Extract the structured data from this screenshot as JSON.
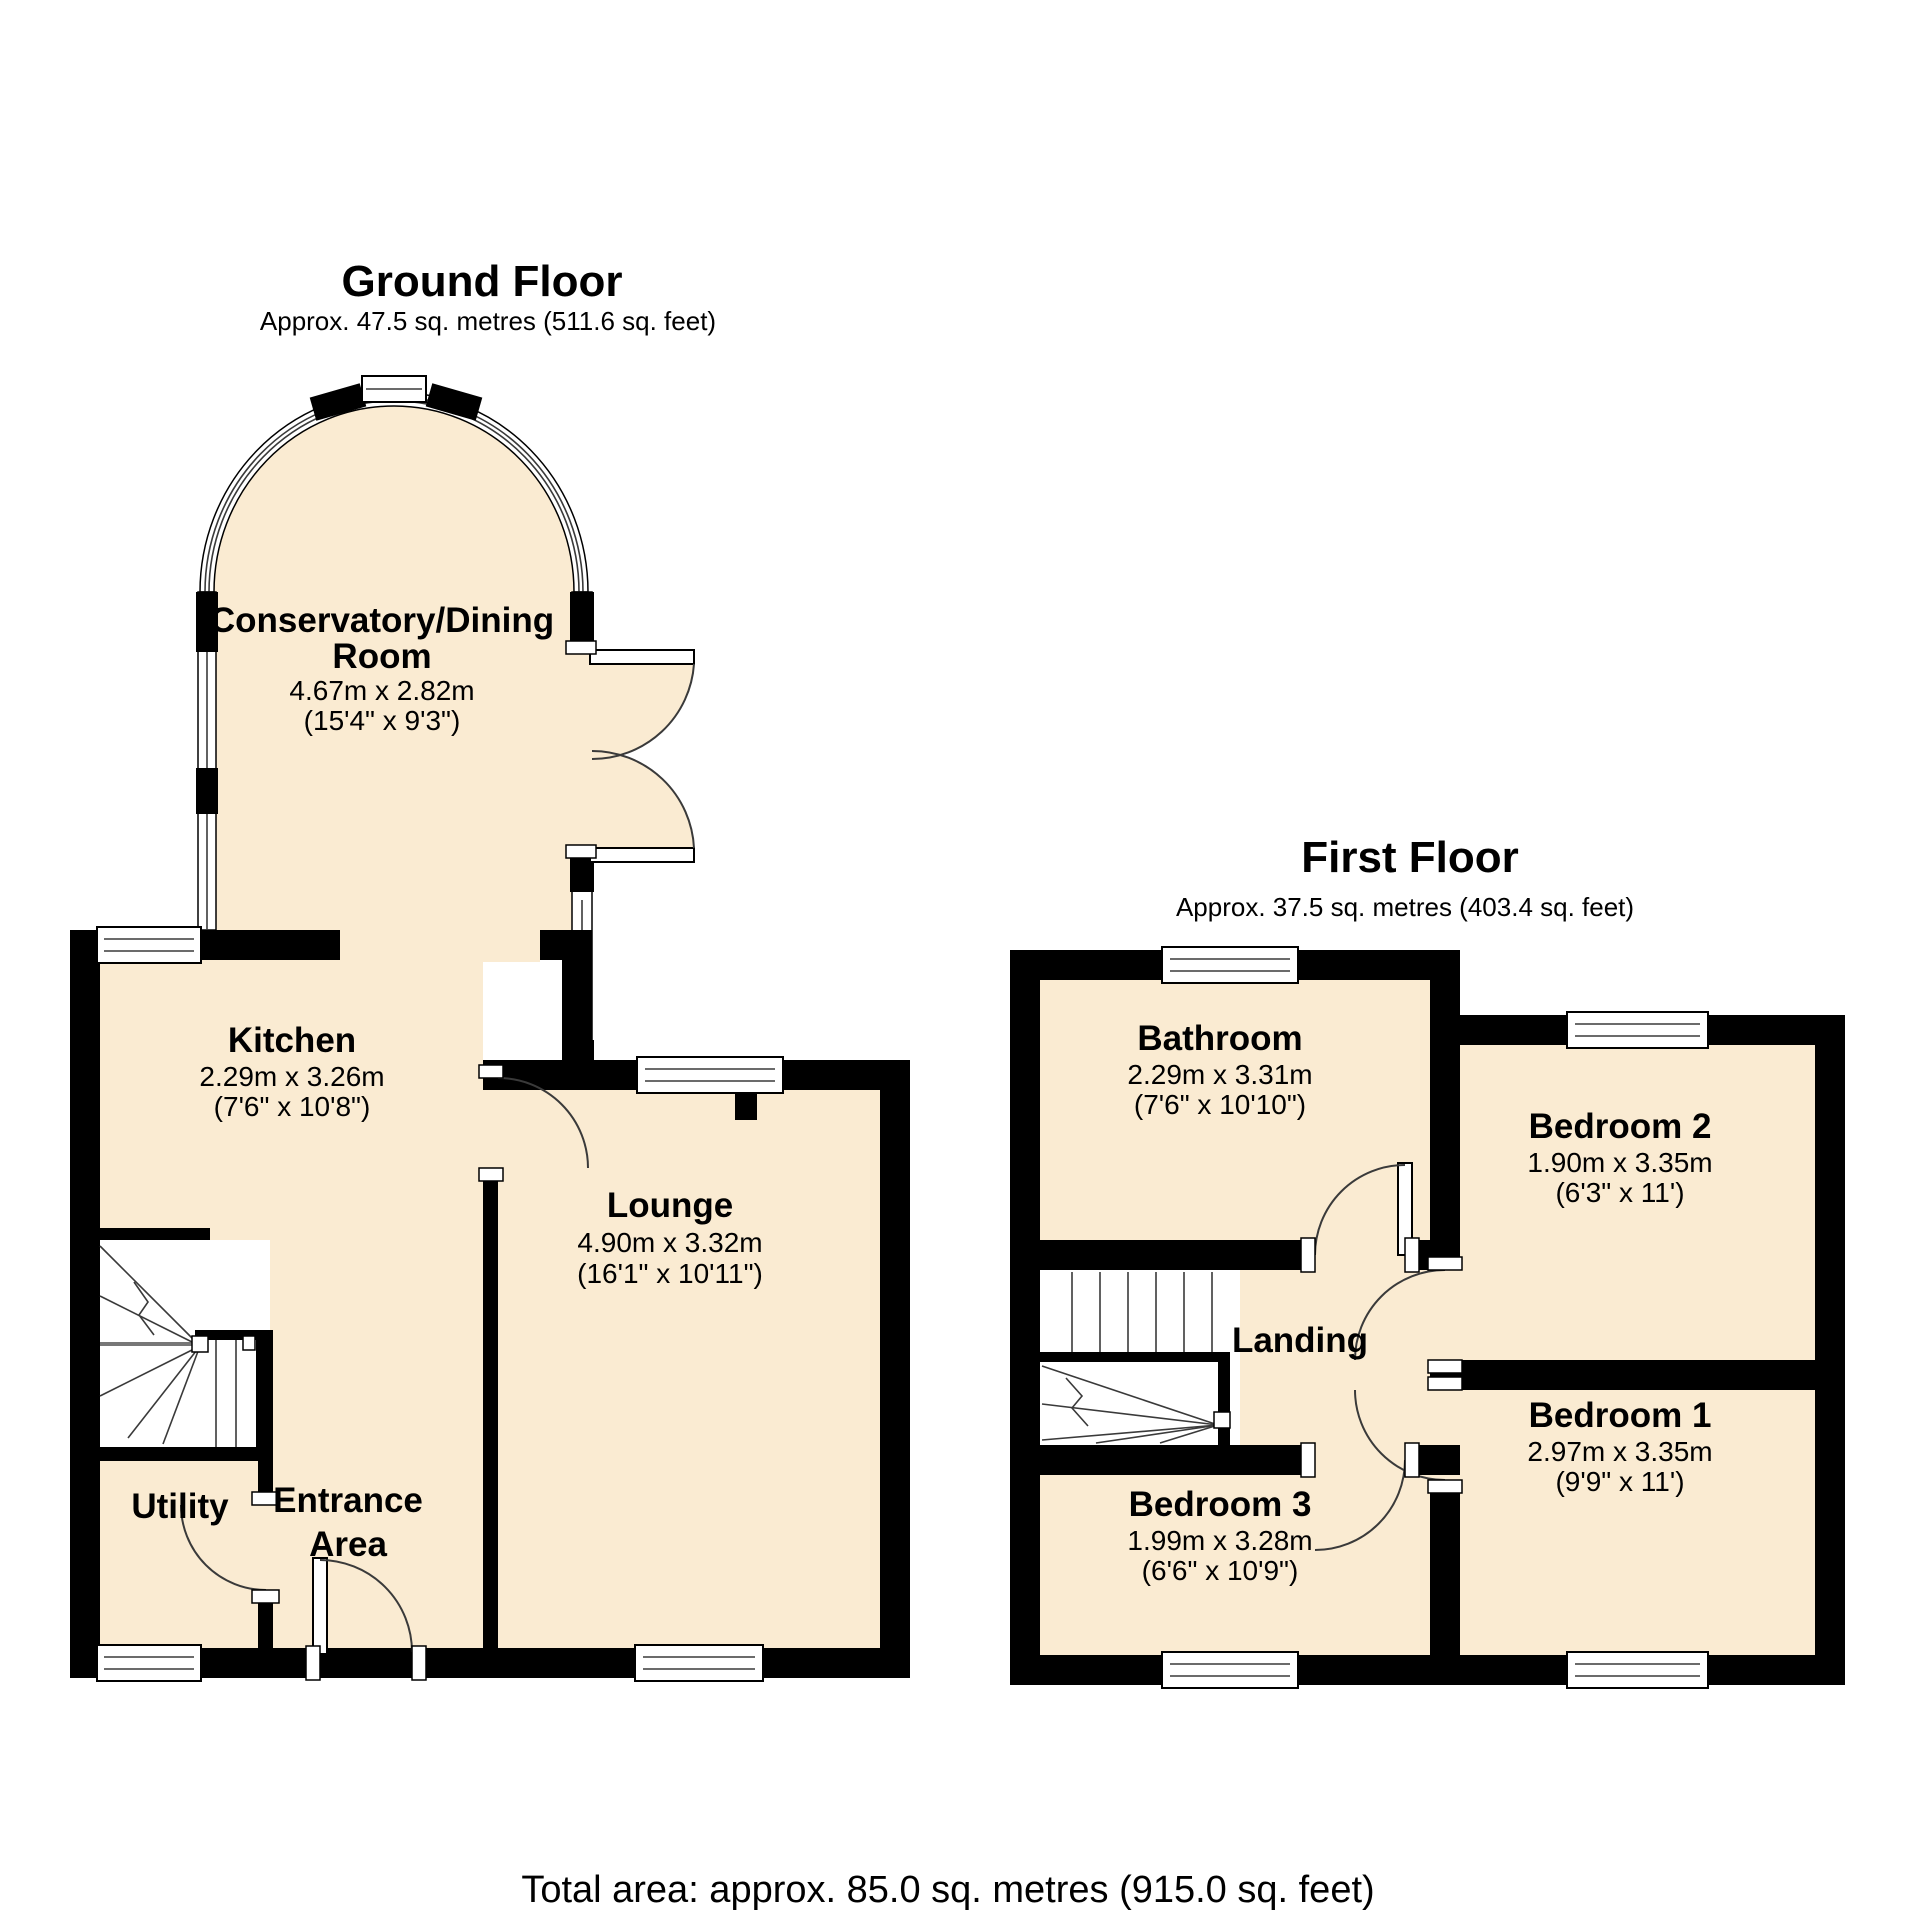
{
  "colors": {
    "room_fill": "#FAEBD2",
    "wall": "#000000",
    "background": "#FFFFFF"
  },
  "ground_floor": {
    "title": "Ground Floor",
    "subtitle": "Approx. 47.5 sq. metres (511.6 sq. feet)",
    "rooms": {
      "conservatory": {
        "name_line1": "Conservatory/Dining",
        "name_line2": "Room",
        "dims_m": "4.67m x 2.82m",
        "dims_ft": "(15'4\" x 9'3\")"
      },
      "kitchen": {
        "name": "Kitchen",
        "dims_m": "2.29m x 3.26m",
        "dims_ft": "(7'6\" x 10'8\")"
      },
      "lounge": {
        "name": "Lounge",
        "dims_m": "4.90m x 3.32m",
        "dims_ft": "(16'1\" x 10'11\")"
      },
      "utility": {
        "name": "Utility"
      },
      "entrance": {
        "name_line1": "Entrance",
        "name_line2": "Area"
      }
    }
  },
  "first_floor": {
    "title": "First Floor",
    "subtitle": "Approx. 37.5 sq. metres (403.4 sq. feet)",
    "rooms": {
      "bathroom": {
        "name": "Bathroom",
        "dims_m": "2.29m x 3.31m",
        "dims_ft": "(7'6\" x 10'10\")"
      },
      "bedroom2": {
        "name": "Bedroom 2",
        "dims_m": "1.90m x 3.35m",
        "dims_ft": "(6'3\" x 11')"
      },
      "landing": {
        "name": "Landing"
      },
      "bedroom1": {
        "name": "Bedroom 1",
        "dims_m": "2.97m x 3.35m",
        "dims_ft": "(9'9\" x 11')"
      },
      "bedroom3": {
        "name": "Bedroom 3",
        "dims_m": "1.99m x 3.28m",
        "dims_ft": "(6'6\" x 10'9\")"
      }
    }
  },
  "footer": {
    "total_area": "Total area: approx. 85.0 sq. metres (915.0 sq. feet)"
  }
}
